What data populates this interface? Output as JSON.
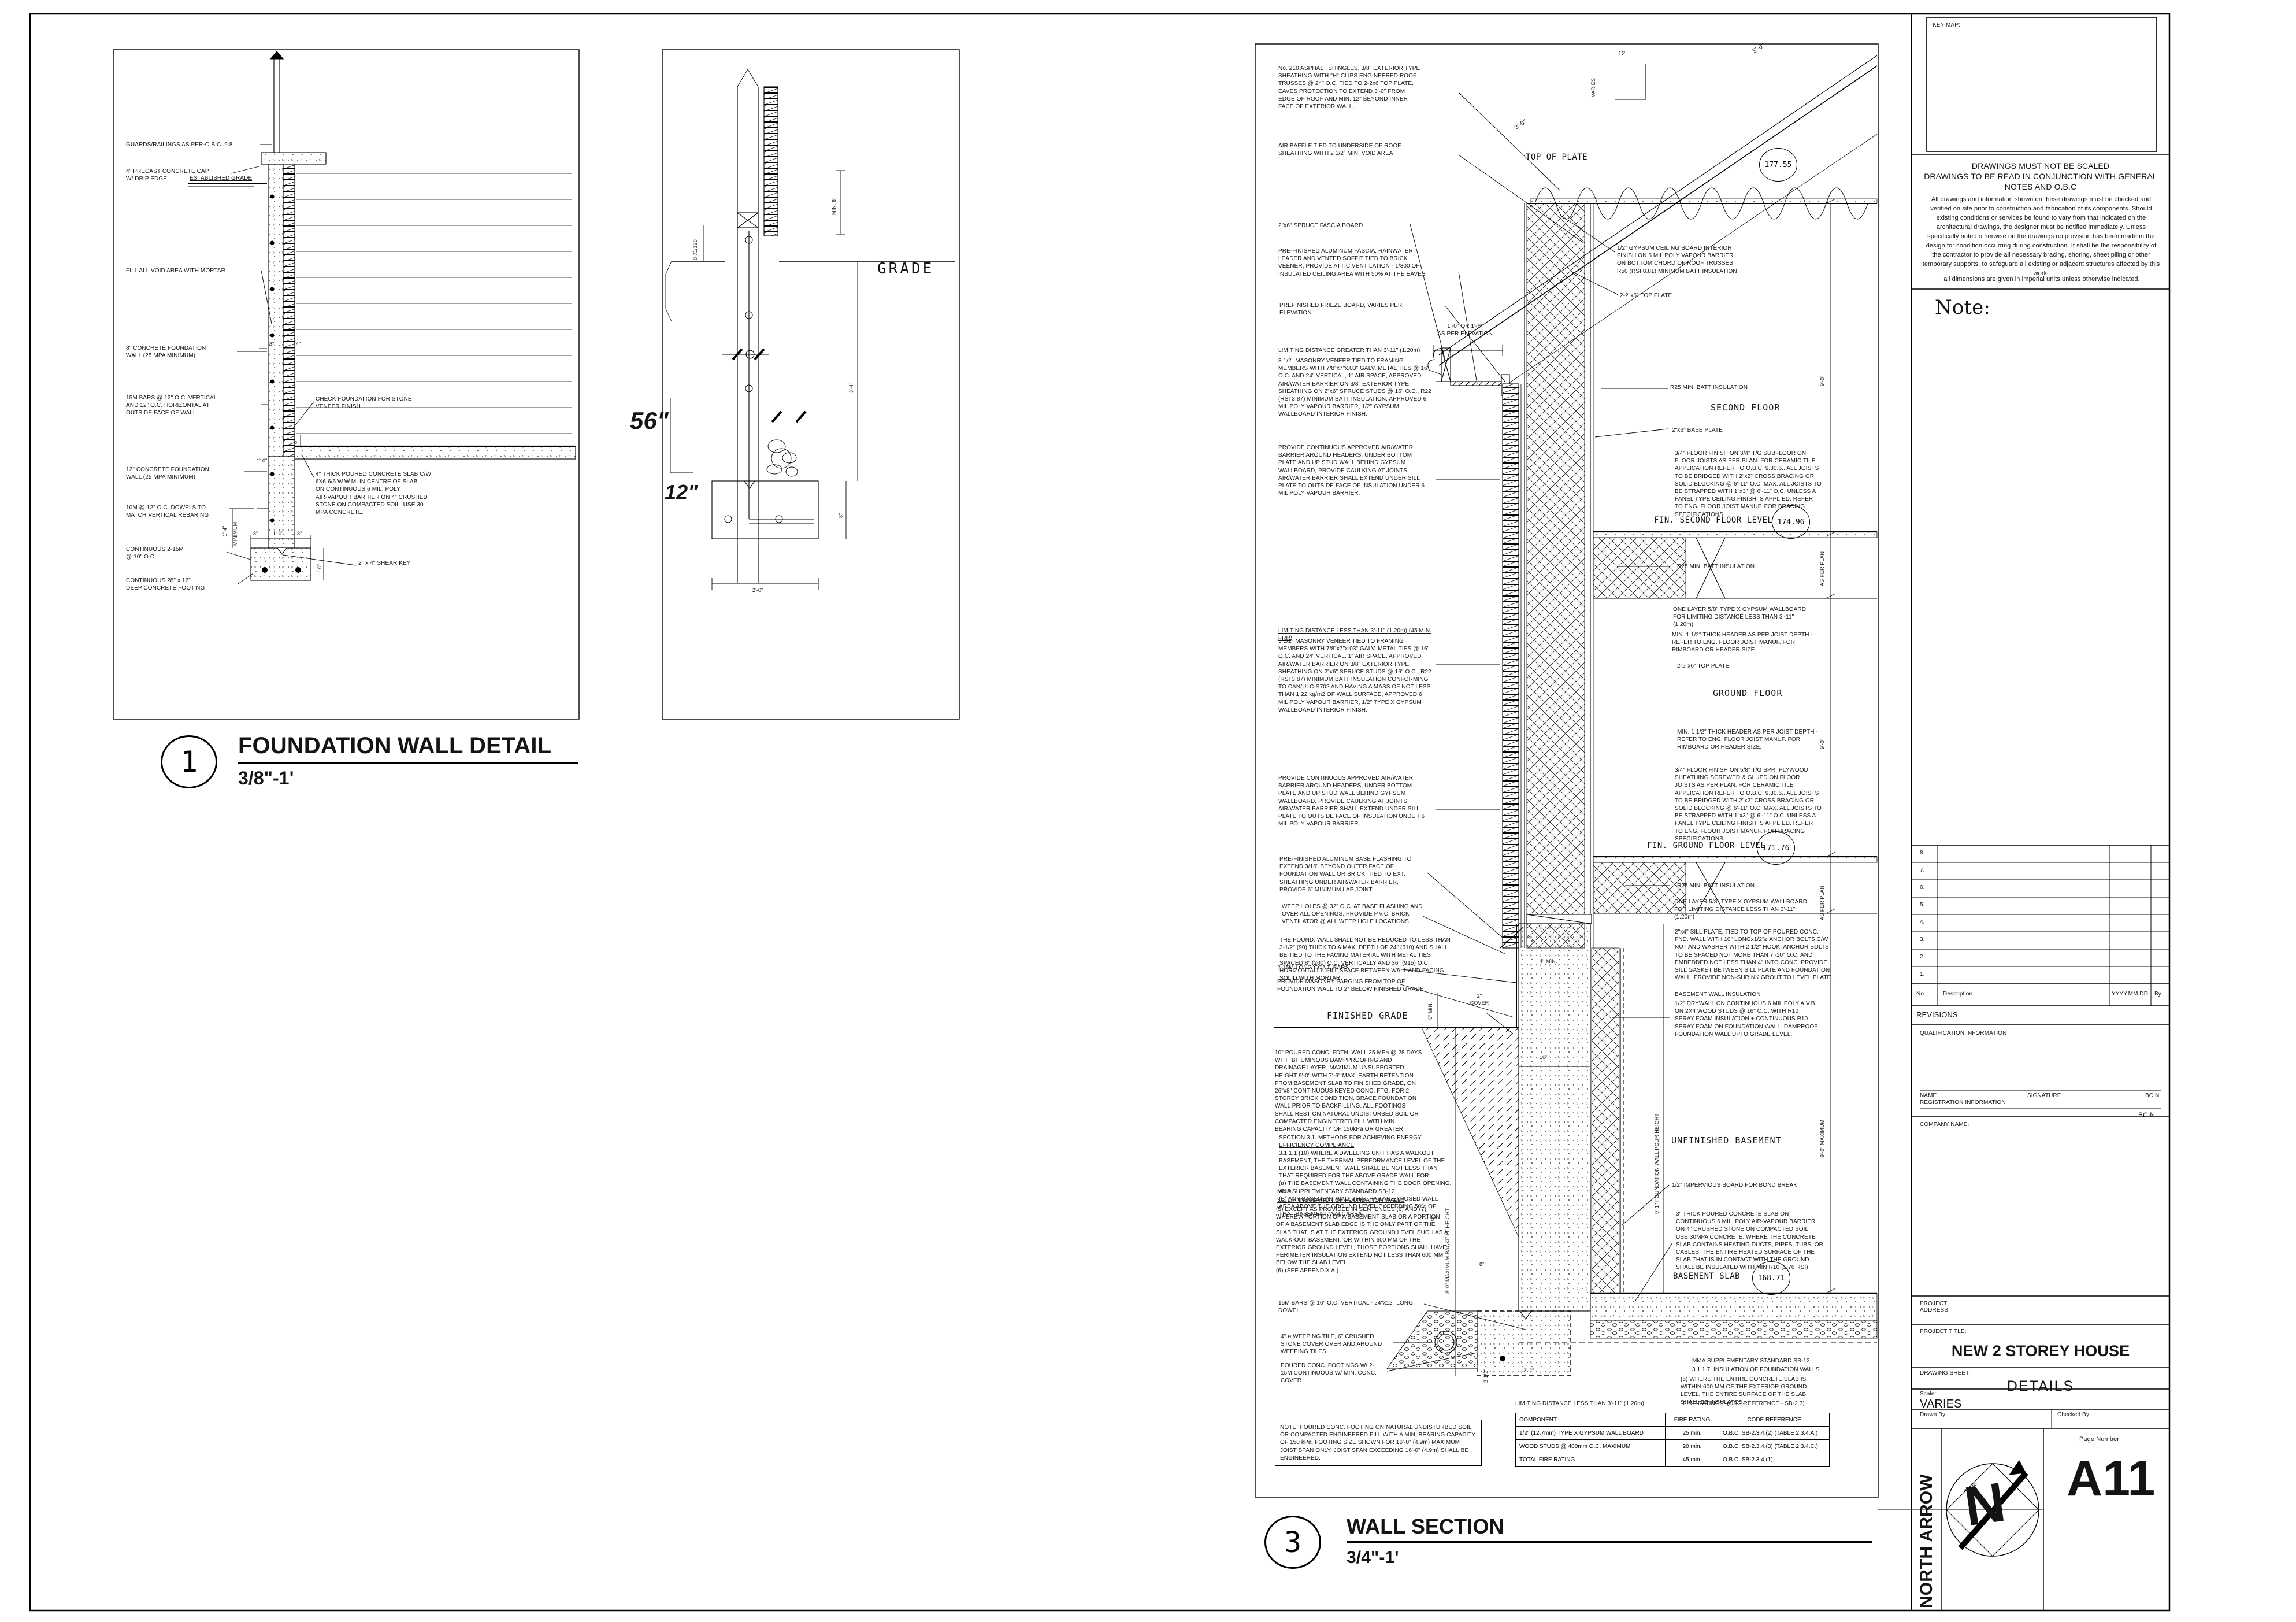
{
  "d1": {
    "num": "1",
    "title": "FOUNDATION WALL DETAIL",
    "scale": "3/8\"-1'",
    "left": [
      "GUARDS/RAILINGS AS PER-O.B.C. 9.8",
      "4\" PRECAST CONCRETE CAP\nW/ DRIP EDGE",
      "ESTABLISHED GRADE",
      "FILL ALL VOID AREA WITH MORTAR",
      "8\" CONCRETE FOUNDATION\nWALL (25 MPA MINIMUM)",
      "15M BARS @ 12\" O.C. VERTICAL\nAND 12\" O.C. HORIZONTAL AT\nOUTSIDE FACE OF WALL",
      "12\" CONCRETE FOUNDATION\nWALL (25 MPA MINIMUM)",
      "10M @ 12\" O.C. DOWELS TO\nMATCH VERTICAL REBARING",
      "CONTINUOUS 2-15M\n@ 10\" O.C",
      "CONTINUOUS 28\" x 12\"\nDEEP CONCRETE FOOTING"
    ],
    "right": [
      "CHECK FOUNDATION FOR STONE\nVENEER FINISH",
      "4\" THICK POURED CONCRETE SLAB C/W\n6X6 6/6 W.W.M. IN CENTRE OF SLAB\nON CONTINUOUS 6 MIL. POLY\nAIR-VAPOUR BARRIER  ON 4\" CRUSHED\nSTONE ON COMPACTED SOIL. USE 30\nMPA CONCRETE.",
      "2\" x 4\" SHEAR KEY"
    ],
    "dims": {
      "w8": "8\"",
      "w4": "4\"",
      "w12": "1'-0\"",
      "min": "1'-4\"",
      "minw": "MINIMUM",
      "f8a": "8\"",
      "f12": "1'-0\"",
      "f8b": "8\"",
      "fd": "1'-0\"",
      "s6": "6\""
    }
  },
  "d2": {
    "grade": "GRADE",
    "d56": "56\"",
    "d12": "12\"",
    "min6": "MIN. 6\"",
    "d871": "8 71/128\"",
    "d34": "3'-4\"",
    "d8": "8\"",
    "d20": "2'-0\""
  },
  "d3": {
    "num": "3",
    "title": "WALL SECTION",
    "scale": "3/4\"-1'",
    "slope_num": "12",
    "slope_lbl": "VARIES",
    "roof_dim": "3'-0\"",
    "eave_dim": "5'-0\"",
    "left": [
      "No. 210 ASPHALT SHINGLES, 3/8\" EXTERIOR TYPE SHEATHING WITH \"H\" CLIPS  ENGINEERED ROOF TRUSSES @ 24\" O.C.  TIED TO 2-2x6 TOP PLATE. EAVES PROTECTION TO EXTEND 3'-0\" FROM EDGE OF ROOF AND MIN. 12\" BEYOND INNER FACE OF EXTERIOR WALL,",
      "AIR BAFFLE TIED TO UNDERSIDE OF ROOF SHEATHING WITH 2 1/2\" MIN. VOID AREA",
      "2\"x6\" SPRUCE FASCIA BOARD",
      "PRE-FINISHED ALUMINUM FASCIA, RAINWATER LEADER AND VENTED SOFFIT TIED TO BRICK VEENER, PROVIDE ATTIC VENTILATION - 1/300 OF INSULATED CEILING AREA WITH 50% AT THE EAVES",
      "PREFINISHED FRIEZE BOARD, VARIES PER ELEVATION",
      "LIMITING DISTANCE GREATER THAN 3'-11\" (1.20m)",
      "3 1/2\" MASONRY VENEER TIED TO FRAMING MEMBERS WITH 7/8\"x7\"x.03\" GALV. METAL TIES @ 16\" O.C. AND 24\" VERTICAL, 1\" AIR SPACE, APPROVED AIR/WATER BARRIER ON 3/8\" EXTERIOR TYPE SHEATHING ON 2\"x6\" SPRUCE STUDS @ 16\" O.C., R22 (RSI 3.87) MINIMUM BATT INSULATION, APPROVED 6 MIL POLY VAPOUR BARRIER, 1/2\" GYPSUM WALLBOARD INTERIOR FINISH.",
      "PROVIDE CONTINUOUS APPROVED AIR/WATER BARRIER AROUND HEADERS, UNDER BOTTOM PLATE AND UP STUD WALL BEHIND GYPSUM WALLBOARD, PROVIDE CAULKING AT JOINTS, AIR/WATER BARRIER SHALL EXTEND UNDER SILL PLATE TO OUTSIDE FACE OF INSULATION UNDER 6 MIL POLY VAPOUR BARRIER.",
      "LIMITING DISTANCE LESS THAN 3'-11\" (1.20m) (45 MIN. FRR)",
      "3 1/2\" MASONRY VENEER TIED TO FRAMING MEMBERS WITH 7/8\"x7\"x.03\" GALV. METAL TIES @ 16\" O.C. AND 24\" VERTICAL, 1\" AIR SPACE, APPROVED AIR/WATER BARRIER ON 3/8\" EXTERIOR TYPE SHEATHING ON 2\"x6\" SPRUCE STUDS @ 16\" O.C., R22 (RSI 3.87) MINIMUM BATT INSULATION CONFORMING TO CAN/ULC-S702 AND HAVING A MASS OF NOT LESS THAN 1.22 kg/m2 OF WALL SURFACE, APPROVED 6 MIL POLY VAPOUR BARRIER, 1/2\" TYPE X GYPSUM WALLBOARD INTERIOR FINISH.",
      "PROVIDE CONTINUOUS APPROVED AIR/WATER BARRIER AROUND HEADERS, UNDER BOTTOM PLATE AND UP STUD WALL BEHIND GYPSUM WALLBOARD, PROVIDE CAULKING AT JOINTS, AIR/WATER BARRIER SHALL EXTEND UNDER SILL PLATE TO OUTSIDE FACE OF INSULATION UNDER 6 MIL POLY VAPOUR BARRIER.",
      "PRE-FINISHED ALUMINUM BASE FLASHING TO EXTEND 3/16\" BEYOND OUTER FACE OF FOUNDATION WALL OR BRICK, TIED TO EXT. SHEATHING UNDER AIR/WATER BARRIER, PROVIDE 6\" MINIMUM LAP JOINT.",
      "WEEP HOLES @ 32\" O.C. AT BASE FLASHING AND OVER ALL OPENINGS. PROVIDE P.V.C. BRICK VENTILATOR @ ALL WEEP HOLE LOCATIONS.",
      "THE FOUND. WALL SHALL NOT BE REDUCED TO LESS THAN 3-1/2\" (90) THICK TO A MAX. DEPTH OF 24\" (610) AND SHALL BE TIED TO THE FACING MATERIAL WITH METAL TIES SPACED 8\" (200) O.C. VERTICALLY AND 36\" (915) O.C. HORIZONTALLY.  FILL SPACE BETWEEN WALL AND FACING SOLID WITH MORTAR.",
      "2-15M LONG CONT. BARS",
      "PROVIDE MASONRY PARGING FROM TOP OF\nFOUNDATION WALL TO 2\" BELOW FINISHED GRADE",
      "FINISHED GRADE",
      "10\" POURED CONC. FDTN. WALL 25 MPa @ 28 DAYS WITH BITUMINOUS DAMPPROOFING AND DRAINAGE LAYER. MAXIMUM UNSUPPORTED HEIGHT 9'-0\" WITH 7'-6\" MAX. EARTH RETENTION FROM BASEMENT SLAB TO FINISHED GRADE, ON 26\"x8\" CONTINUOUS KEYED CONC. FTG. FOR 2 STOREY BRICK CONDITION. BRACE FOUNDATION WALL PRIOR TO BACKFILLING. ALL FOOTINGS SHALL REST ON NATURAL UNDISTURBED SOIL OR COMPACTED ENGINEERED FILL WITH MIN.  BEARING CAPACITY OF 150kPa OR GREATER.",
      "SECTION 3.1. METHODS FOR ACHIEVING ENERGY EFFICIENCY COMPLIANCE",
      "3.1.1.1 (10) WHERE A DWELLING UNIT HAS A WALKOUT BASEMENT, THE THERMAL PERFORMANCE LEVEL OF THE EXTERIOR BASEMENT WALL SHALL BE NOT LESS THAN THAT REQUIRED FOR THE ABOVE GRADE WALL FOR:\n(a)      THE BASEMENT WALL CONTAINING THE DOOR OPENING, AND\n(B)      ANY BASEMENT WALL THAT HAS AN EXPOSED WALL AREA ABOVE THE GROUND LEVEL EXCEEDING 50% OF THAT BASEMENT WALL AREA.",
      "MMA SUPPLEMENTARY STANDARD SB-12",
      "3.1.1.7. INSULATION OF FOUNDATION WALLS",
      "(5)      EXCEPT AS PROVIDED IN SENTENCES (6) AND (7), WHERE A PORTION OF A BASEMENT SLAB OR A PORTION OF A BASEMENT SLAB EDGE IS THE ONLY PART OF THE SLAB THAT IS AT THE EXTERIOR GROUND LEVEL SUCH AS A WALK-OUT BASEMENT, OR WITHIN 600 MM OF THE EXTERIOR GROUND LEVEL, THOSE PORTIONS SHALL HAVE PERIMETER INSULATION EXTEND NOT LESS THAN 600 MM BELOW THE SLAB LEVEL.\n(6)      (SEE APPENDIX A.)",
      "15M BARS @ 16\" O.C. VERTICAL - 24\"x12\" LONG DOWEL",
      "4\" ø WEEPING TILE, 6\" CRUSHED STONE COVER OVER AND AROUND WEEPING TILES.",
      "POURED CONC. FOOTINGS W/ 2-15M CONTINUOUS W/ MIN. CONC. COVER",
      "NOTE: POURED CONC. FOOTING ON NATURAL UNDISTURBED SOIL OR COMPACTED ENGINEERED FILL WITH A MIN. BEARING CAPACITY OF 150 kPa. FOOTING SIZE SHOWN FOR 16'-0\" (4.9m) MAXIMUM JOIST SPAN ONLY. JOIST SPAN EXCEEDING 16'-0\" (4.9m) SHALL BE ENGINEERED."
    ],
    "right": [
      "1/2\" GYPSUM CEILING BOARD INTERIOR FINISH ON 6 MIL POLY VAPOUR BARRIER ON BOTTOM CHORD OF ROOF TRUSSES, R50 (RSI 8.81) MINIMUM BATT INSULATION",
      "2-2\"x6\" TOP PLATE",
      "R25 MIN. BATT INSULATION",
      "2\"x6\" BASE PLATE",
      "3/4\" FLOOR FINISH ON 3/4\" T/G SUBFLOOR ON FLOOR JOISTS AS PER PLAN. FOR CERAMIC TILE APPLICATION REFER TO O.B.C. 9.30.6.. ALL JOISTS TO BE BRIDGED WITH 2\"x2\" CROSS BRACING OR SOLID BLOCKING @ 6'-11\" O.C. MAX.  ALL JOISTS TO BE STRAPPED WITH 1\"x3\" @ 6'-11\" O.C. UNLESS A PANEL TYPE CEILING FINISH IS APPLIED. REFER TO ENG. FLOOR JOIST MANUF. FOR BRACING SPECIFICATIONS.",
      "R25 MIN. BATT INSULATION",
      "ONE LAYER 5/8\" TYPE X GYPSUM WALLBOARD FOR LIMITING DISTANCE LESS THAN 3'-11\" (1.20m)",
      "MIN. 1 1/2\" THICK HEADER AS PER JOIST DEPTH - REFER TO ENG. FLOOR JOIST MANUF. FOR RIMBOARD OR HEADER SIZE.",
      "2-2\"x6\" TOP PLATE",
      "MIN. 1 1/2\" THICK HEADER AS PER JOIST DEPTH - REFER TO ENG. FLOOR JOIST MANUF. FOR RIMBOARD OR HEADER SIZE.",
      "3/4\" FLOOR FINISH ON 5/8\" T/G SPR. PLYWOOD SHEATHING SCREWED & GLUED ON FLOOR JOISTS AS PER PLAN. FOR CERAMIC TILE APPLICATION REFER TO O.B.C. 9.30.6.. ALL JOISTS TO BE BRIDGED WITH 2\"x2\" CROSS BRACING OR SOLID BLOCKING @ 6'-11\" O.C. MAX.  ALL JOISTS TO BE STRAPPED WITH 1\"x3\" @ 6'-11\" O.C. UNLESS A PANEL TYPE CEILING FINISH IS APPLIED. REFER TO ENG. FLOOR JOIST MANUF. FOR BRACING SPECIFICATIONS.",
      "R25 MIN. BATT INSULATION",
      "ONE LAYER 5/8\" TYPE X GYPSUM WALLBOARD FOR LIMITING DISTANCE LESS THAN 3'-11\" (1.20m)",
      "2\"x4\" SILL PLATE, TIED TO TOP OF POURED CONC. FND. WALL WITH 10\" LONGx1/2\"ø ANCHOR BOLTS C/W NUT AND WASHER WITH 2 1/2\" HOOK.  ANCHOR BOLTS TO BE SPACED NOT MORE THAN 7'-10\" O.C. AND EMBEDDED NOT LESS THAN 4\" INTO CONC.  PROVIDE SILL GASKET BETWEEN SILL PLATE AND FOUNDATION WALL.  PROVIDE NON-SHRINK GROUT TO LEVEL PLATE.",
      "BASEMENT WALL INSULATION",
      "1/2\" DRYWALL ON CONTINUOUS 6 MIL POLY A.V.B. ON 2X4 WOOD STUDS @ 16\" O.C. WITH R10 SPRAY FOAM INSULATION + CONTINUOUS R10 SPRAY FOAM ON FOUNDATION WALL. DAMPROOF FOUNDATION WALL UPTO GRADE LEVEL.",
      "1/2\" IMPERVIOUS BOARD FOR BOND BREAK",
      "3\" THICK POURED CONCRETE SLAB ON CONTINUOUS 6 MIL. POLY AIR-VAPOUR BARRIER ON 4\" CRUSHED STONE ON COMPACTED SOIL. USE 30MPA CONCRETE. WHERE THE CONCRETE SLAB CONTAINS HEATING DUCTS, PIPES, TUBS, OR CABLES, THE ENTIRE HEATED SURFACE OF THE SLAB THAT IS IN CONTACT WITH THE GROUND SHALL BE INSULATED WITH MIN R10 (1.76 RSI)",
      "MMA SUPPLEMENTARY STANDARD SB-12",
      "3.1.1.7. INSULATION OF FOUNDATION WALLS",
      "(6)      WHERE THE ENTIRE CONCRETE SLAB IS WITHIN 600 MM OF THE EXTERIOR GROUND LEVEL, THE ENTIRE SURFACE OF THE SLAB SHALL BE INSULATED."
    ],
    "levels": [
      {
        "l": "TOP OF PLATE",
        "v": "177.55"
      },
      {
        "l": "FIN. SECOND FLOOR LEVEL",
        "v": "174.96"
      },
      {
        "l": "FIN. GROUND FLOOR LEVEL",
        "v": "171.76"
      },
      {
        "l": "BASEMENT SLAB",
        "v": "168.71"
      }
    ],
    "floors": [
      "SECOND FLOOR",
      "GROUND FLOOR",
      "UNFINISHED BASEMENT"
    ],
    "vdims": [
      "9'-0\"",
      "AS PER PLAN",
      "9'-0\"",
      "AS PER PLAN",
      "9'-0\" MAXIMUM"
    ],
    "backfill": "8'-0\" MAXIMUM BACKFILL HEIGHT",
    "pour": "9'-1\" FOUNDATION WALL POUR HEIGHT",
    "dims": {
      "min6": "6\" MIN.",
      "cover": "2\"\nCOVER",
      "t10": "10\"",
      "e8a": "8\"",
      "e8b": "8\"",
      "min4": "4\" MIN.",
      "d2h": "2 1/2\"",
      "w22": "2'-2\"",
      "elev": "1'-0\" OR 1'-6\"\nAS PER ELEVATION"
    },
    "table": {
      "t1": "LIMITING DISTANCE LESS THAN 3'-11\" (1.20m)",
      "t2": "FIRE RATINGS: (OBC REFERENCE - SB-2.3)",
      "head": [
        "COMPONENT",
        "FIRE RATING",
        "CODE REFERENCE"
      ],
      "rows": [
        [
          "1/2\" (12.7mm) TYPE X GYPSUM WALL BOARD",
          "25 min.",
          "O.B.C. SB-2.3.4.(2) (TABLE 2.3.4.A.)"
        ],
        [
          "WOOD STUDS @ 400mm O.C. MAXIMUM",
          "20 min.",
          "O.B.C. SB-2.3.4.(3) (TABLE 2.3.4.C.)"
        ],
        [
          "TOTAL FIRE RATING",
          "45 min.",
          "O.B.C. SB-2.3.4.(1)"
        ]
      ]
    }
  },
  "tb": {
    "keymap": "KEY MAP:",
    "n1": "DRAWINGS MUST NOT BE SCALED",
    "n2": "DRAWINGS TO BE READ IN CONJUNCTION WITH GENERAL NOTES AND O.B.C",
    "body": "All drawings and information shown on these drawings must be checked and verified on site prior to construction and fabrication of its components. Should existing conditions or services be found to vary from that indicated on the architectural drawings, the designer must be notified immediately.  Unless specifically noted otherwise on the drawings no provision has been made in the design for condition occurring during construction.  It shall be the responsibility of the contractor to provide all necessary bracing, shoring, sheet piling or other temporary supports, to safeguard all existing or adjacent structures affected by this work.",
    "units": "all dimensions are given in imperial units unless otherwise indicated.",
    "note": "Note:",
    "rev_rows": [
      "8.",
      "7.",
      "6.",
      "5.",
      "4.",
      "3.",
      "2.",
      "1."
    ],
    "rev_no": "No.",
    "rev_desc": "Description",
    "rev_date": "YYYY.MM.DD",
    "rev_by": "By",
    "revisions": "REVISIONS",
    "qual": "QUALIFICATION INFORMATION",
    "name": "NAME",
    "sig": "SIGNATURE",
    "bcin": "BCIN",
    "reg": "REGISTRATION INFORMATION",
    "bcin2": "BCIN",
    "company": "COMPANY NAME:",
    "addr": "PROJECT\nADDRESS:",
    "pt_l": "PROJECT TITLE:",
    "pt": "NEW 2 STOREY HOUSE",
    "ds_l": "DRAWING SHEET:",
    "ds": "DETAILS",
    "sc_l": "Scale:",
    "sc": "VARIES",
    "db": "Drawn By:",
    "cb": "Checked By",
    "north": "NORTH ARROW",
    "north_n": "N",
    "true": "TRUE",
    "pn_l": "Page Number",
    "pn": "A11"
  }
}
